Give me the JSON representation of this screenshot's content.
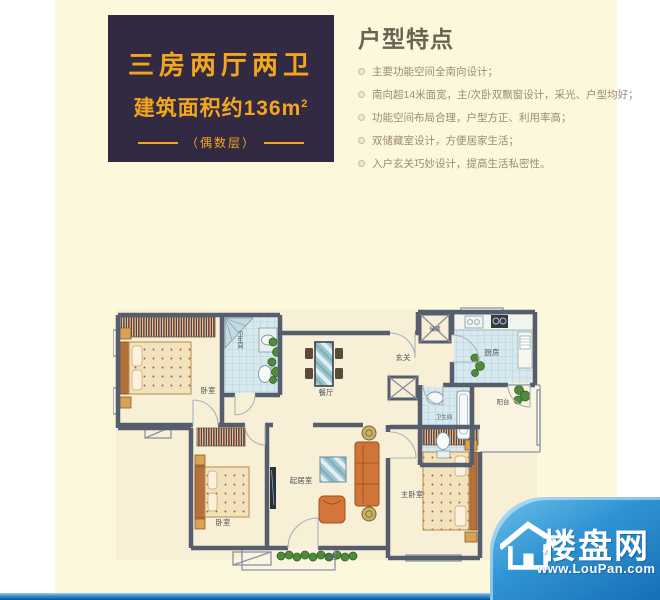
{
  "colors": {
    "page_bg": "#ffffff",
    "content_bg": "#fcf8dc",
    "spec_box_bg": "#322a42",
    "accent_gold": "#f2a71f",
    "feature_title": "#6b6254",
    "feature_text": "#9c8c72",
    "wall": "#565e6d",
    "tile_blue": "#d7e9ef",
    "furniture_orange": "#d0753a",
    "brand_blue": "#2f93d3"
  },
  "spec_box": {
    "line1": "三房两厅两卫",
    "line2_prefix": "建筑面积约",
    "line2_value": "136m",
    "line2_sup": "2",
    "line3": "（偶数层）"
  },
  "features": {
    "title": "户型特点",
    "items": [
      "主要功能空间全南向设计；",
      "南向超14米面宽，主/次卧双飘窗设计，采光、户型均好；",
      "功能空间布局合理，户型方正、利用率高；",
      "双储藏室设计，方便居家生活；",
      "入户玄关巧妙设计，提高生活私密性。"
    ]
  },
  "floorplan": {
    "rooms": [
      {
        "label": "卧室"
      },
      {
        "label": "卫生间"
      },
      {
        "label": "餐厅"
      },
      {
        "label": "玄关"
      },
      {
        "label": "储藏"
      },
      {
        "label": "厨房"
      },
      {
        "label": "阳台"
      },
      {
        "label": "卫生间"
      },
      {
        "label": "起居室"
      },
      {
        "label": "卧室"
      },
      {
        "label": "主卧室"
      },
      {
        "label": "阳台"
      }
    ]
  },
  "brand": {
    "name": "楼盘网",
    "url": "www.LouPan.com"
  }
}
